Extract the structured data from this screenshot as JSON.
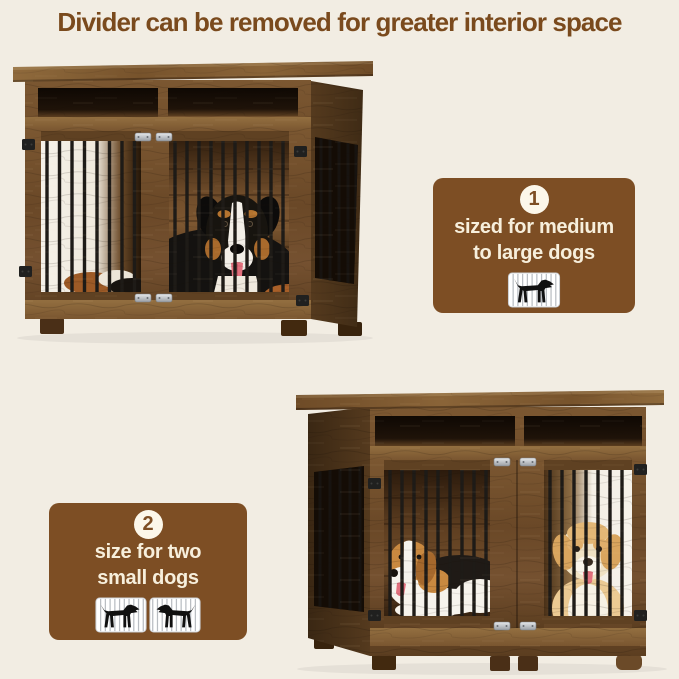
{
  "page": {
    "background_color": "#f2ede3",
    "accent_brown": "#7d4e24",
    "cream_text": "#f7efdc",
    "bar_black": "#1e1b17"
  },
  "title": {
    "text": "Divider can be removed for greater interior space",
    "color": "#7a4a1d"
  },
  "callouts": [
    {
      "badge": "1",
      "line1": "sized for medium",
      "line2": "to large dogs",
      "icon": "dog-in-cage-icon"
    },
    {
      "badge": "2",
      "line1": "size for two",
      "line2": "small dogs",
      "icon": "two-dogs-in-cages-icon"
    }
  ],
  "photos": [
    {
      "name": "crate-with-large-dog-photo",
      "description": "rustic wooden dog crate furniture with open top shelves, barred doors and one medium-large dog inside"
    },
    {
      "name": "crate-with-two-small-dogs-photo",
      "description": "same wooden dog crate with divider, holding two small dogs in separate compartments"
    }
  ]
}
